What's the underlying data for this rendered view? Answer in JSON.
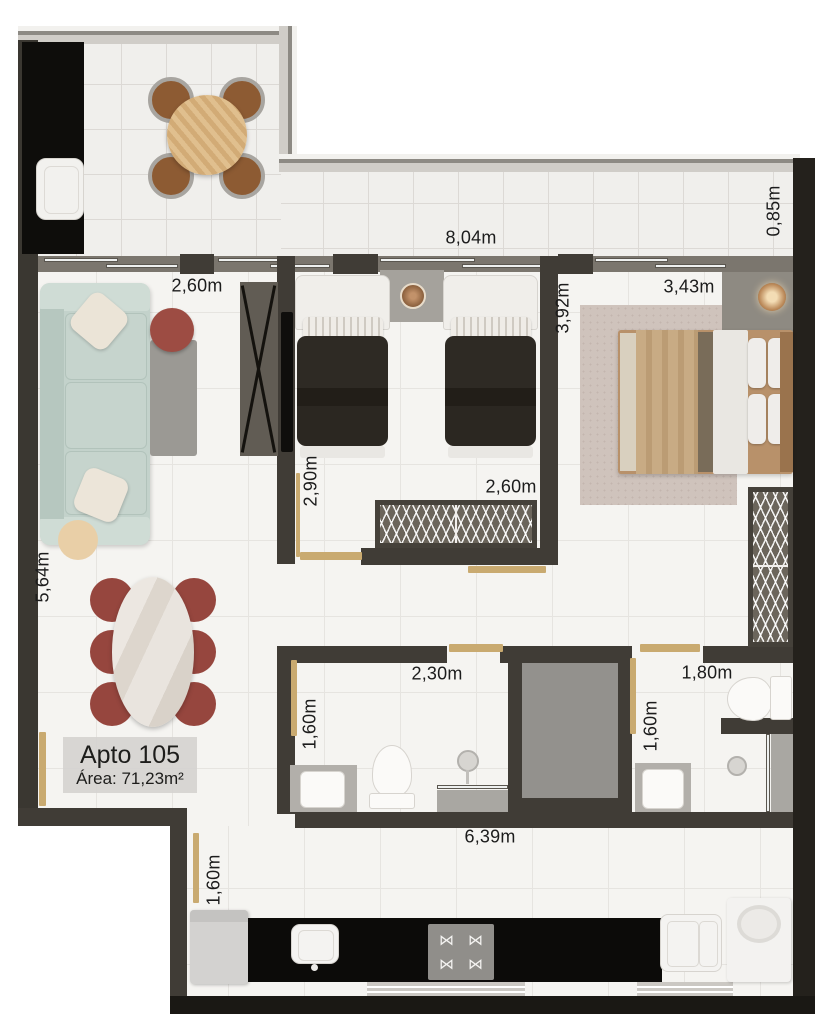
{
  "plan": {
    "unit_label": "Apto 105",
    "area_label": "Área: 71,23m²"
  },
  "dimensions": [
    {
      "id": "balcony-length",
      "text": "8,04m",
      "x": 471,
      "y": 238,
      "rot": 0
    },
    {
      "id": "balcony-depth",
      "text": "0,85m",
      "x": 774,
      "y": 211,
      "rot": -90
    },
    {
      "id": "living-width",
      "text": "2,60m",
      "x": 197,
      "y": 286,
      "rot": 0
    },
    {
      "id": "bedroom2-depth",
      "text": "3,92m",
      "x": 563,
      "y": 308,
      "rot": -90
    },
    {
      "id": "master-width",
      "text": "3,43m",
      "x": 689,
      "y": 287,
      "rot": 0
    },
    {
      "id": "bedroom2-length",
      "text": "2,90m",
      "x": 311,
      "y": 481,
      "rot": -90
    },
    {
      "id": "bedroom2-width",
      "text": "2,60m",
      "x": 511,
      "y": 487,
      "rot": 0
    },
    {
      "id": "living-length",
      "text": "5,64m",
      "x": 43,
      "y": 577,
      "rot": -90
    },
    {
      "id": "bath1-width",
      "text": "2,30m",
      "x": 437,
      "y": 674,
      "rot": 0
    },
    {
      "id": "bath2-width",
      "text": "1,80m",
      "x": 707,
      "y": 673,
      "rot": 0
    },
    {
      "id": "bath1-depth",
      "text": "1,60m",
      "x": 310,
      "y": 724,
      "rot": -90
    },
    {
      "id": "bath2-depth",
      "text": "1,60m",
      "x": 651,
      "y": 726,
      "rot": -90
    },
    {
      "id": "kitchen-length",
      "text": "6,39m",
      "x": 490,
      "y": 837,
      "rot": 0
    },
    {
      "id": "kitchen-passage",
      "text": "1,60m",
      "x": 214,
      "y": 880,
      "rot": -90
    }
  ],
  "icons": {
    "burner": "⋈"
  },
  "colors": {
    "wall": "#403c36",
    "wall_dark": "#24211c",
    "floor": "#f5f4f1",
    "balcony_floor": "#f0efec",
    "door_wood": "#c9aa70",
    "sofa": "#c3d2cb",
    "accent_chair": "#9d4c43",
    "dining_chair": "#96463e",
    "bed_duvet_dark": "#2b2721",
    "master_bed_tan": "#c8ab84",
    "counter_black": "#0c0b09",
    "shaft_gray": "#93918d"
  }
}
